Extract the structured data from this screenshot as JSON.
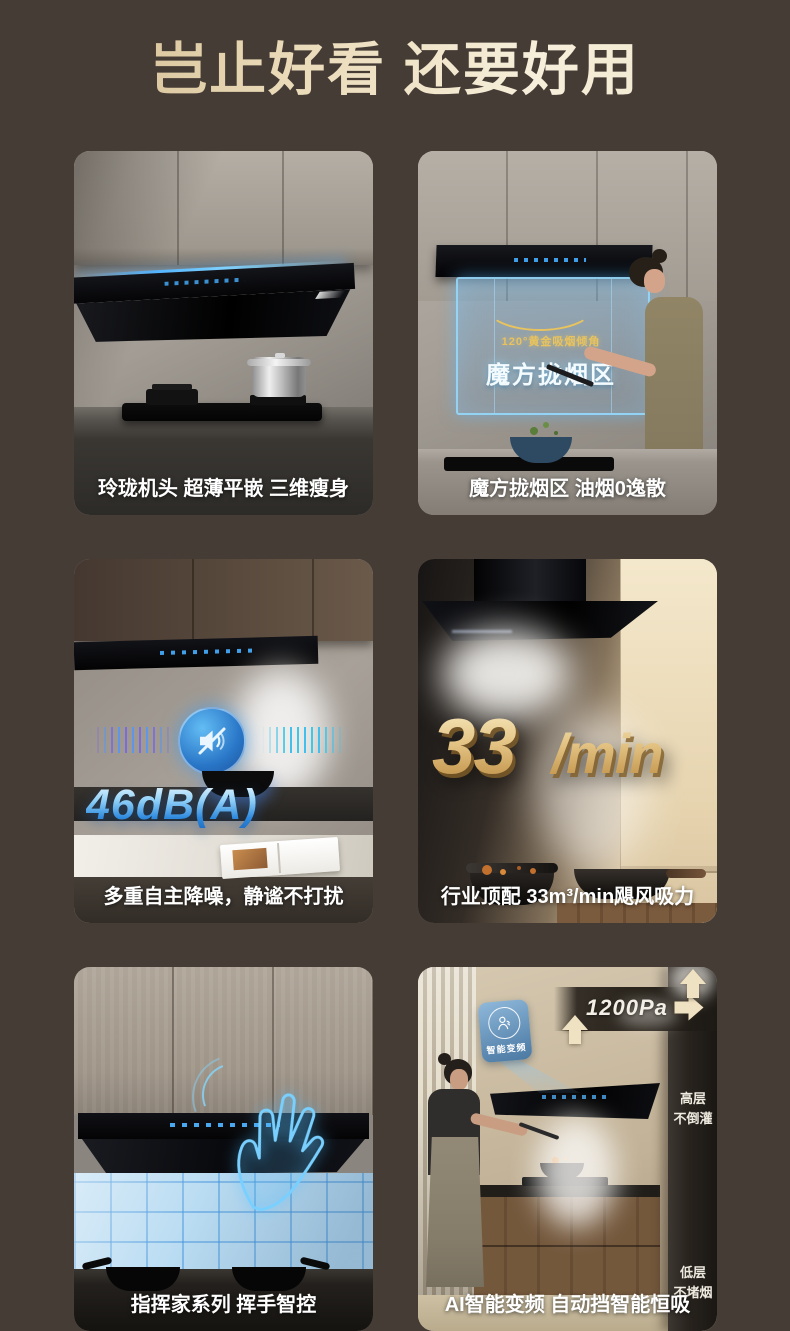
{
  "title": "岂止好看 还要好用",
  "colors": {
    "page_bg": "#463c36",
    "title_gold": "#ecdcb4",
    "caption_white": "#ffffff",
    "holo_blue": "#7fd4ff",
    "gold_accent": "#e8c35e",
    "db_blue": "#4aa4ec",
    "flow_gold": "#cfa964",
    "badge_blue": "#6fa3cd",
    "arrow_cream": "#efe2c2"
  },
  "icons": {
    "mute-speaker-icon": "speaker with slash in blue circle",
    "person-breath-icon": "person exhaling inside ring on blue badge",
    "hand-outline-icon": "holographic hand wave",
    "arrow-up-icon": "cream upward airflow arrow",
    "arrow-right-icon": "cream rightward airflow arrow"
  },
  "cards": [
    {
      "caption": "玲珑机头 超薄平嵌 三维瘦身"
    },
    {
      "caption": "魔方拢烟区 油烟0逸散",
      "angle_label": "120°黄金吸烟倾角",
      "zone_label": "魔方拢烟区"
    },
    {
      "caption": "多重自主降噪，静谧不打扰",
      "noise_level": "46dB(A)"
    },
    {
      "caption": "行业顶配 33m³/min飓风吸力",
      "flow_value": "33",
      "flow_unit_sup": "m³",
      "flow_unit_rest": "/min"
    },
    {
      "caption": "指挥家系列 挥手智控"
    },
    {
      "caption": "AI智能变频 自动挡智能恒吸",
      "badge_label": "智能变频",
      "pressure_label": "1200Pa",
      "duct_top_label": "高层\n不倒灌",
      "duct_bottom_label": "低层\n不堵烟"
    }
  ]
}
